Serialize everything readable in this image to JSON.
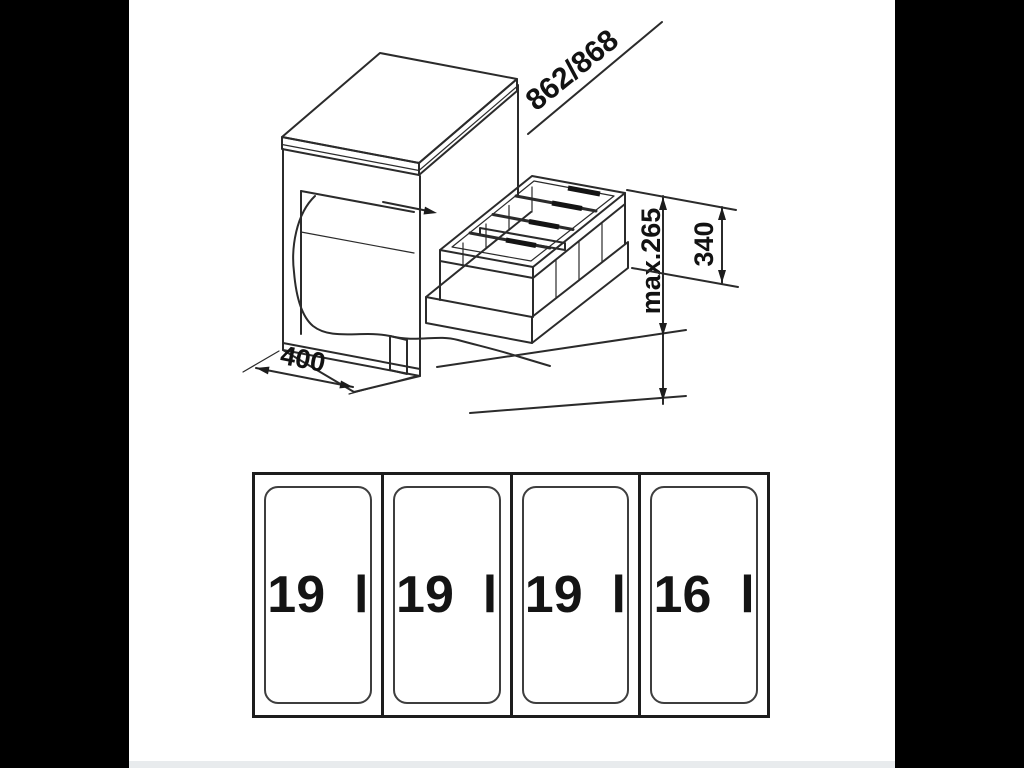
{
  "page": {
    "background": "#000000",
    "canvas_background": "#ffffff",
    "footer_strip_color": "#e8ebed",
    "line_color": "#2b2b2b"
  },
  "drawing": {
    "dimensions": {
      "top_diagonal": "862/868",
      "height_max": "max.265",
      "unit_height": "340",
      "cabinet_width": "400"
    }
  },
  "plan_view": {
    "bins": [
      {
        "label": "19  l"
      },
      {
        "label": "19  l"
      },
      {
        "label": "19  l"
      },
      {
        "label": "16  l"
      }
    ]
  }
}
